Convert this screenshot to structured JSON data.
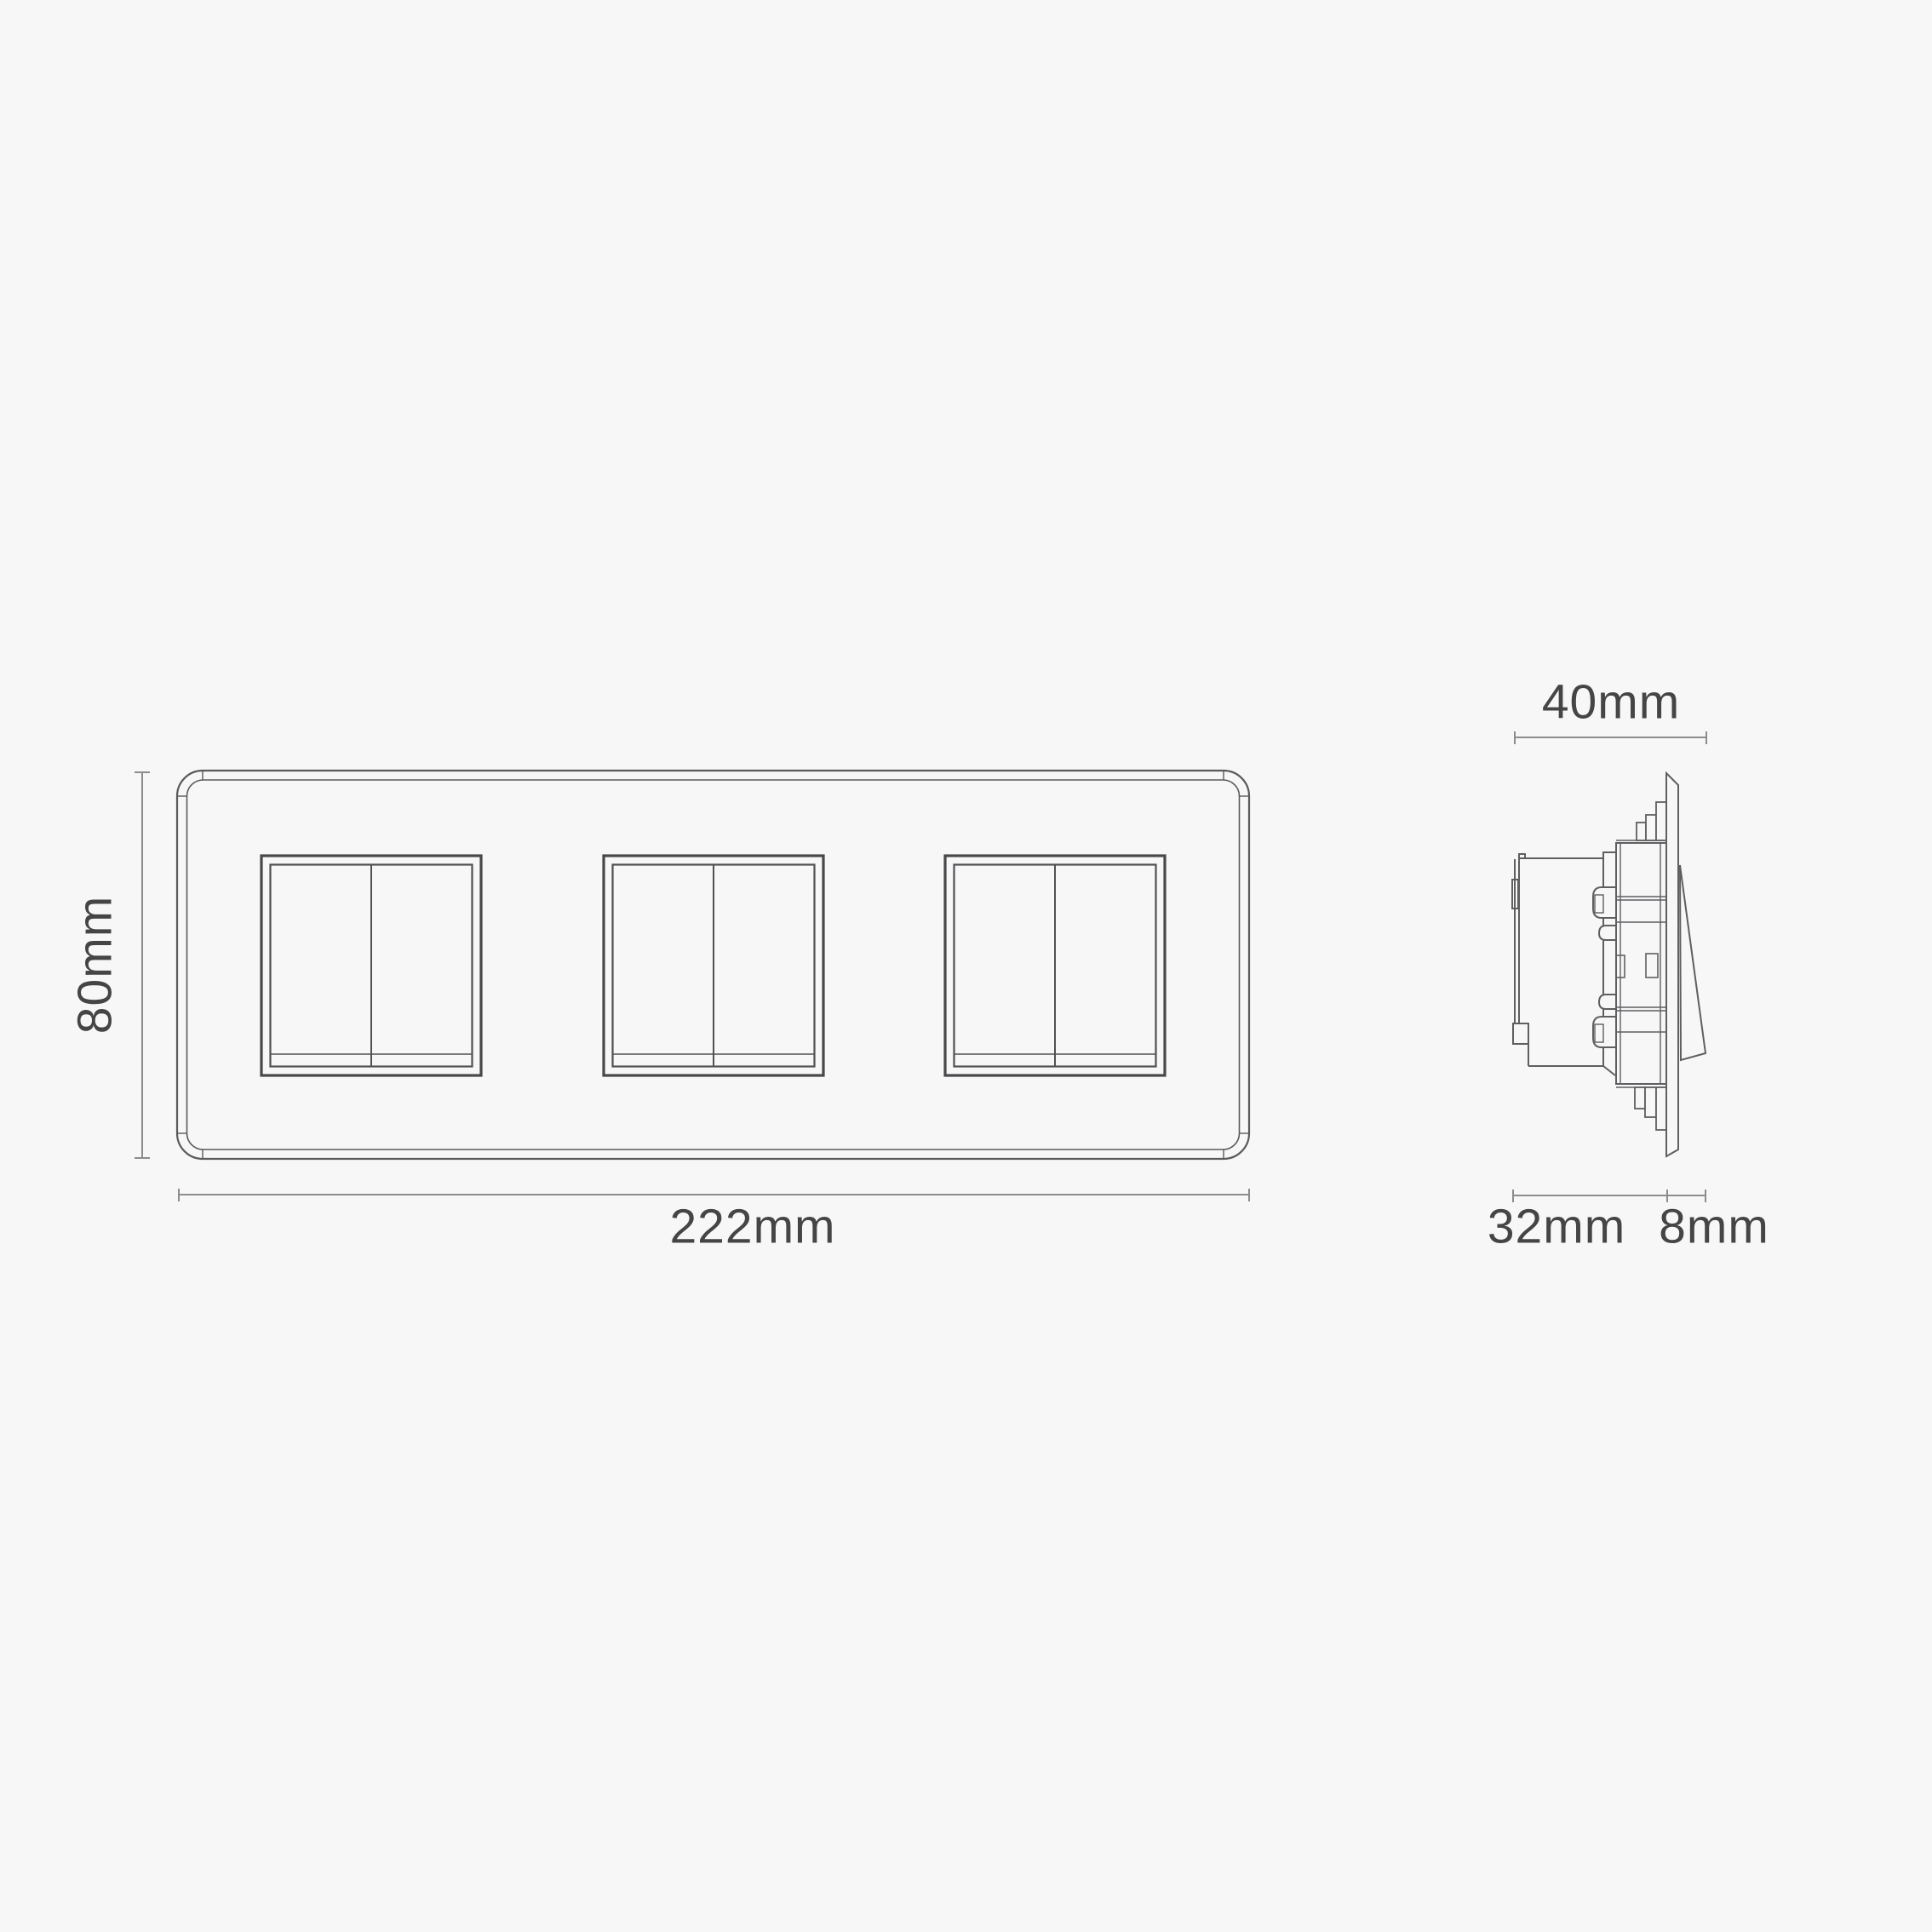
{
  "title": "Triple double-rocker switch dimension drawing",
  "colors": {
    "background": "#f7f7f7",
    "line": "#5f5f62",
    "line_strong": "#48484b",
    "dimension_line": "#8c8c8c",
    "text": "#454545"
  },
  "front_view": {
    "name": "front-elevation-3-gang-double-rocker-plate",
    "gangs": 3,
    "rockers_per_gang": 2,
    "width_label": "222mm",
    "height_label": "80mm"
  },
  "side_view": {
    "name": "side-elevation-switch-mechanism",
    "overall_depth_label": "40mm",
    "recessed_depth_label": "32mm",
    "protrusion_label": "8mm"
  }
}
